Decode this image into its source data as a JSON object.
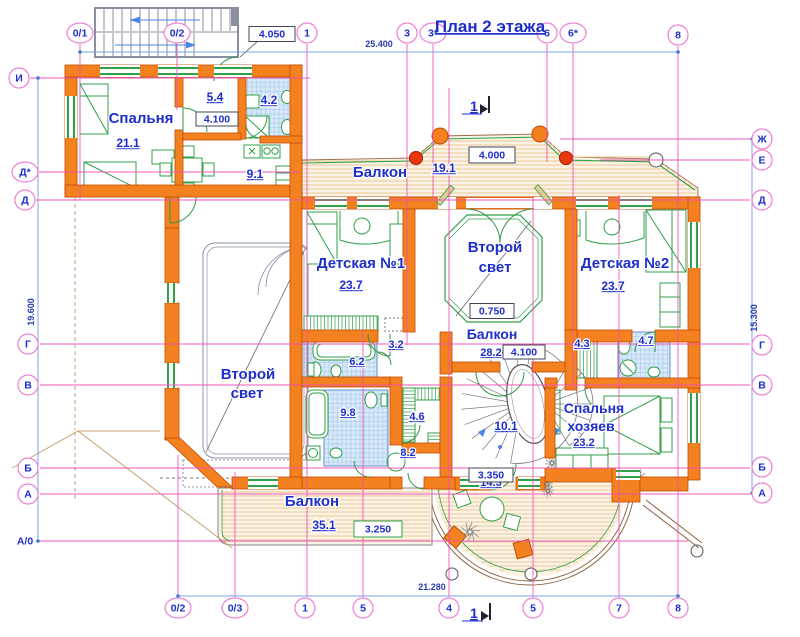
{
  "title": "План 2 этажа",
  "section_marks": [
    "1",
    "1"
  ],
  "axes": {
    "top": [
      "0/1",
      "0/2",
      "1",
      "3",
      "3*",
      "6",
      "6*",
      "8"
    ],
    "bottom": [
      "0/2",
      "0/3",
      "1",
      "5",
      "4",
      "5",
      "7",
      "8"
    ],
    "left": [
      "И",
      "Д*",
      "Д",
      "Г",
      "В",
      "Б",
      "А",
      "А/0"
    ],
    "right": [
      "Ж",
      "Е",
      "Д",
      "Г",
      "В",
      "Б",
      "А"
    ]
  },
  "overall_dimensions": {
    "top": "25.400",
    "bottom": "21.280",
    "left": "19.600",
    "right": "15.300"
  },
  "rooms": [
    {
      "name": "Спальня",
      "area": "21.1"
    },
    {
      "name": "",
      "area": "5.4"
    },
    {
      "name": "",
      "area": "4.2"
    },
    {
      "name": "",
      "area": "9.1"
    },
    {
      "name": "Балкон",
      "area": "19.1"
    },
    {
      "name": "Детская №1",
      "area": "23.7"
    },
    {
      "name": "Второй свет",
      "area": ""
    },
    {
      "name": "Балкон",
      "area": "28.2"
    },
    {
      "name": "Детская №2",
      "area": "23.7"
    },
    {
      "name": "",
      "area": "3.2"
    },
    {
      "name": "",
      "area": "6.2"
    },
    {
      "name": "",
      "area": "4.3"
    },
    {
      "name": "",
      "area": "4.7"
    },
    {
      "name": "Второй свет",
      "area": ""
    },
    {
      "name": "",
      "area": "9.8"
    },
    {
      "name": "",
      "area": "4.6"
    },
    {
      "name": "",
      "area": "8.2"
    },
    {
      "name": "",
      "area": "10.1"
    },
    {
      "name": "",
      "area": "14.3"
    },
    {
      "name": "Спальня хозяев",
      "area": "23.2"
    },
    {
      "name": "Балкон",
      "area": "35.1"
    }
  ],
  "dimension_boxes": [
    "4.050",
    "4.100",
    "4.000",
    "0.750",
    "4.100",
    "3.350",
    "3.250"
  ],
  "colors": {
    "wall": "#F4811F",
    "wall_stroke": "#C24A00",
    "furniture_green": "#2FA148",
    "axis_pink": "#F052B4",
    "label_blue": "#1E2ECB",
    "tile_blue": "#D7E9F9",
    "deck_stripe": "#E9C797",
    "red_column": "#E8380D",
    "dim_line_blue": "#7AA4E6"
  }
}
